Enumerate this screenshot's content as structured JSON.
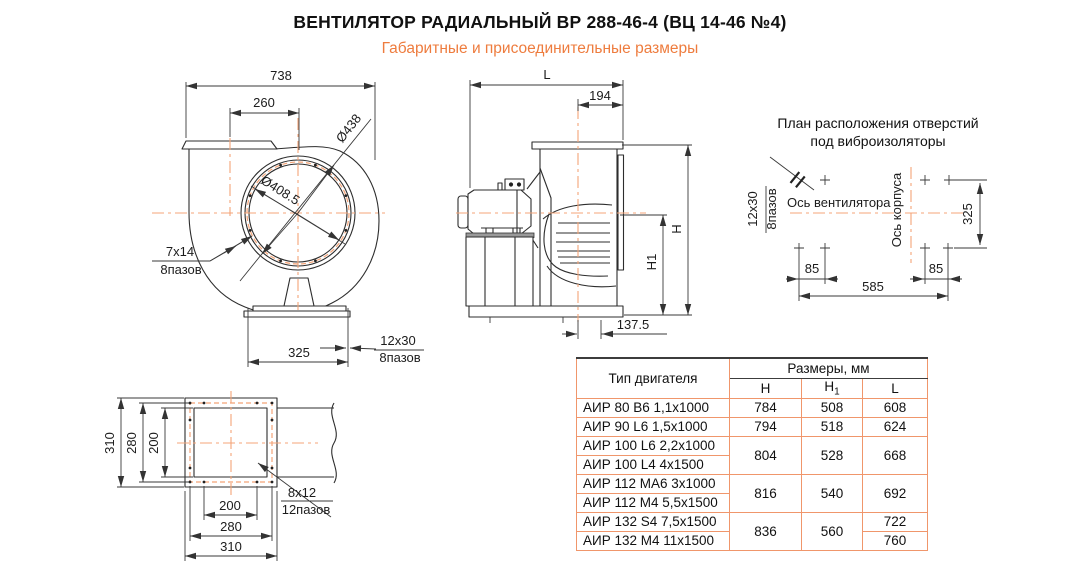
{
  "page": {
    "title": "ВЕНТИЛЯТОР РАДИАЛЬНЫЙ ВР 288-46-4 (ВЦ 14-46 №4)",
    "subtitle": "Габаритные и присоединительные размеры"
  },
  "colors": {
    "accent": "#EE7C3E",
    "centerline": "#F4A478",
    "table-border": "#F0966B"
  },
  "front_view": {
    "dim_width": "738",
    "dim_inlet_offset": "260",
    "dia_inlet_collar": "Ø438",
    "dia_inlet": "Ø408.5",
    "slot_size": "7x14",
    "slot_count": "8пазов",
    "dim_base": "325",
    "base_slot_size": "12x30",
    "base_slot_count": "8пазов"
  },
  "side_view": {
    "dim_length": "L",
    "dim_outlet": "194",
    "dim_height": "H",
    "dim_height1": "H1",
    "dim_axis_offset": "137.5"
  },
  "plan_view": {
    "title_line1": "План расположения отверстий",
    "title_line2": "под виброизоляторы",
    "slot_size": "12x30",
    "slot_count": "8пазов",
    "fan_axis": "Ось вентилятора",
    "body_axis": "Ось корпуса",
    "dim_325": "325",
    "dim_85_left": "85",
    "dim_85_right": "85",
    "dim_585": "585"
  },
  "flange_view": {
    "dim_v310": "310",
    "dim_v280": "280",
    "dim_v200": "200",
    "dim_h200": "200",
    "dim_h280": "280",
    "dim_h310": "310",
    "slot_size": "8x12",
    "slot_count": "12пазов"
  },
  "table": {
    "col_motor": "Тип двигателя",
    "col_sizes": "Размеры, мм",
    "col_h": "Н",
    "col_h1": {
      "main": "Н",
      "sub": "1"
    },
    "col_l": "L",
    "rows": [
      {
        "motor": "АИР 80 В6 1,1x1000",
        "h": "784",
        "h_span": 1,
        "h1": "508",
        "h1_span": 1,
        "l": "608",
        "l_span": 1
      },
      {
        "motor": "АИР 90 L6 1,5x1000",
        "h": "794",
        "h_span": 1,
        "h1": "518",
        "h1_span": 1,
        "l": "624",
        "l_span": 1
      },
      {
        "motor": "АИР 100 L6 2,2x1000",
        "h": "804",
        "h_span": 2,
        "h1": "528",
        "h1_span": 2,
        "l": "668",
        "l_span": 2
      },
      {
        "motor": "АИР 100 L4 4x1500"
      },
      {
        "motor": "АИР 112 МА6 3x1000",
        "h": "816",
        "h_span": 2,
        "h1": "540",
        "h1_span": 2,
        "l": "692",
        "l_span": 2
      },
      {
        "motor": "АИР 112 М4 5,5x1500"
      },
      {
        "motor": "АИР 132 S4 7,5x1500",
        "h": "836",
        "h_span": 2,
        "h1": "560",
        "h1_span": 2,
        "l": "722",
        "l_span": 1
      },
      {
        "motor": "АИР 132 М4 11x1500",
        "l": "760",
        "l_span": 1
      }
    ]
  }
}
